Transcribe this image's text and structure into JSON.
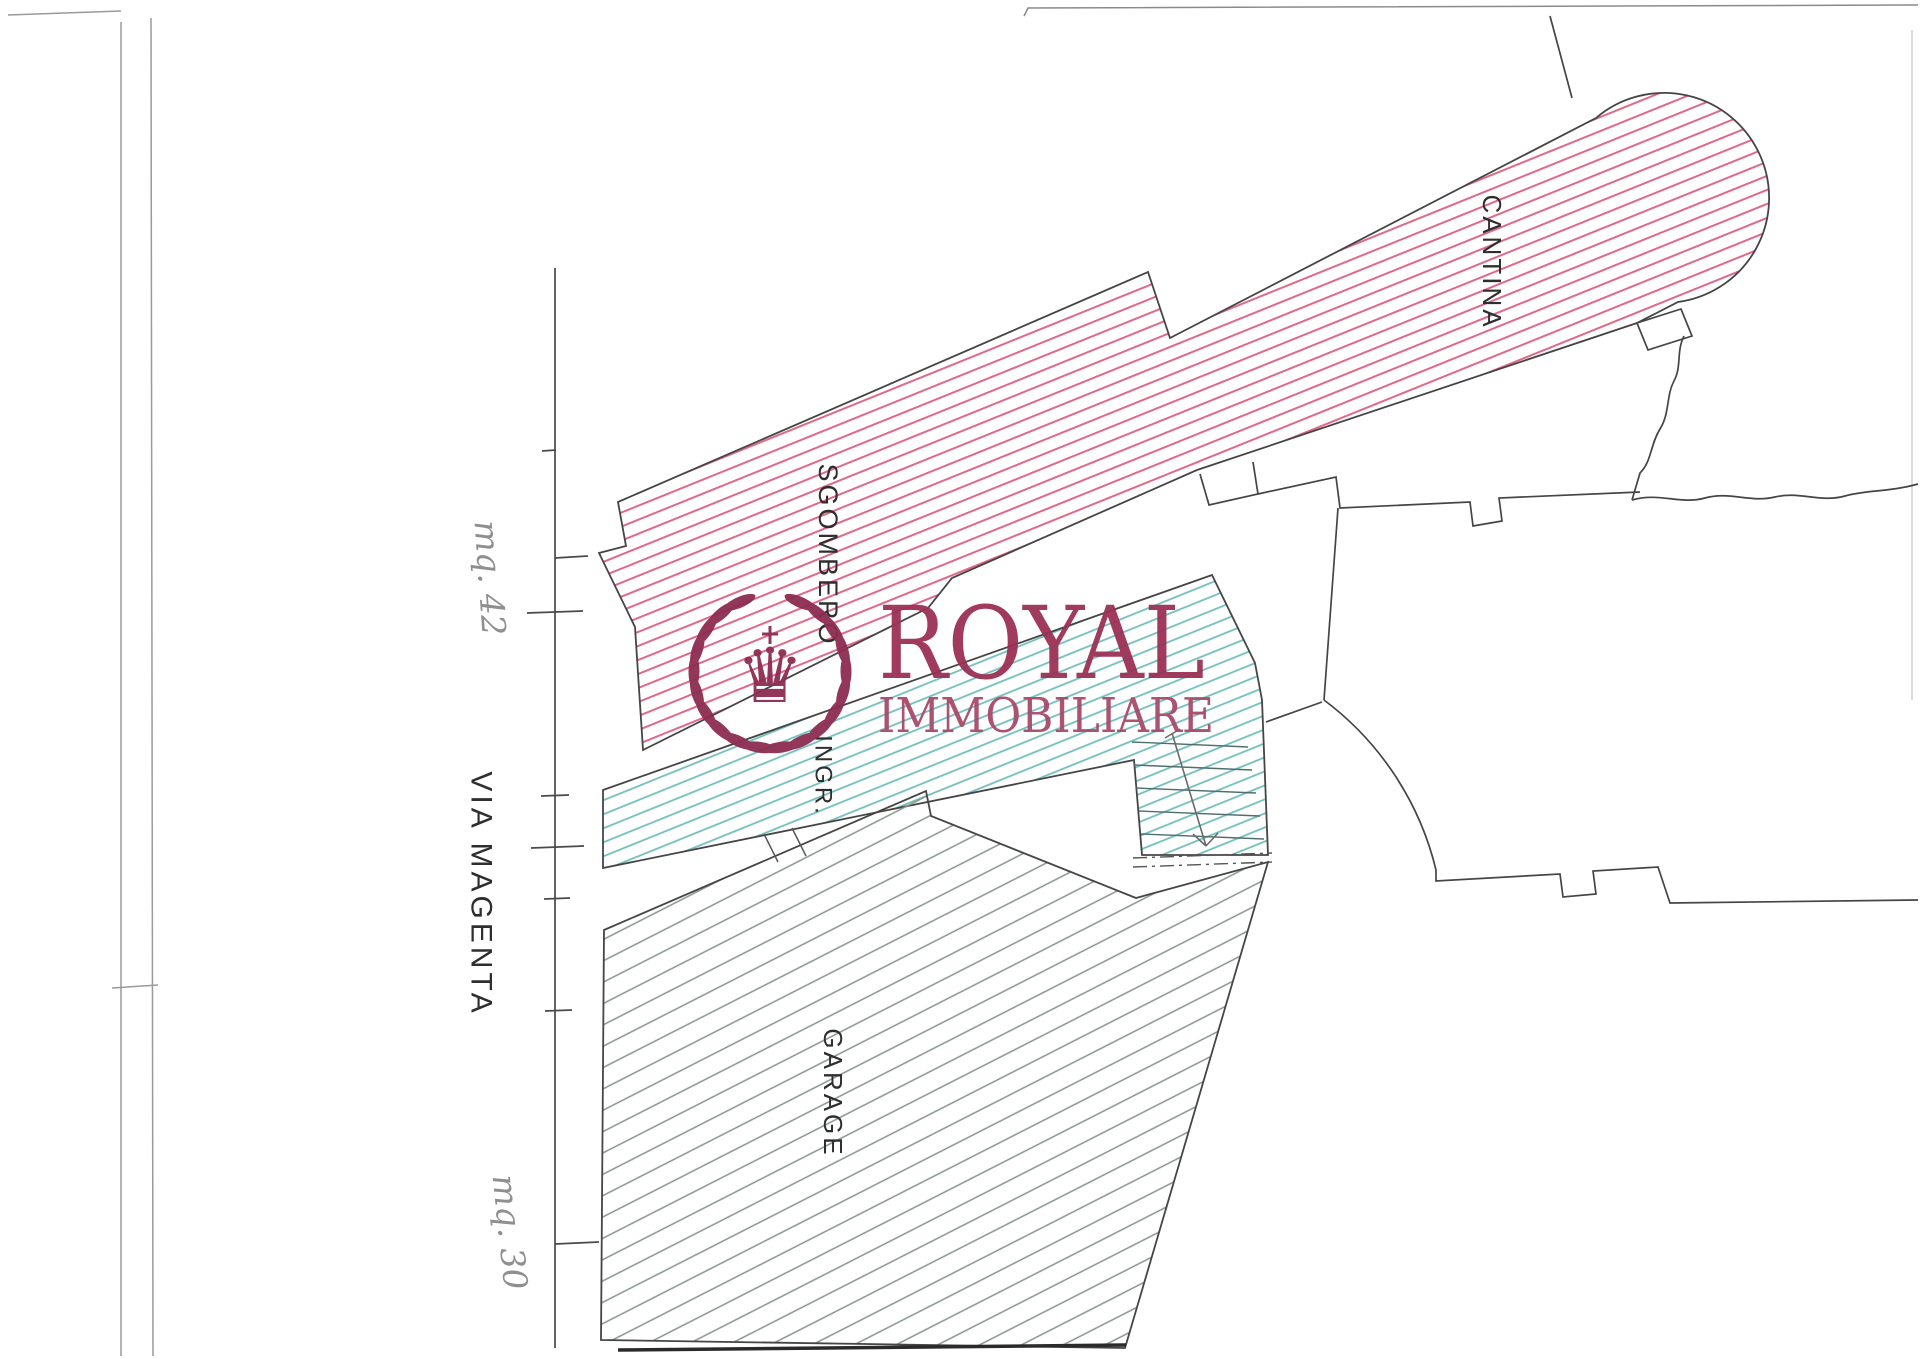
{
  "plan": {
    "rooms": {
      "sgombero": "SGOMBERO",
      "cantina": "CANTINA",
      "ingresso": "INGR.",
      "garage": "GARAGE"
    },
    "street": "VIA MAGENTA",
    "annotations": {
      "sgombero_area": "mq. 42",
      "garage_area": "mq. 30"
    }
  },
  "logo": {
    "name": "ROYAL",
    "subtitle": "IMMOBILIARE",
    "crown_icon": "crown-icon",
    "wreath_icon": "laurel-wreath-icon",
    "crown_glyph": "♛"
  },
  "colors": {
    "pink_hatch": "#e2688a",
    "teal_hatch": "#72bfbc",
    "gray_hatch": "#87948c",
    "outline": "#454545",
    "street_line": "#4a4a4a",
    "logo_maroon": "#9b3156",
    "logo_maroon_dark": "#8e2d52",
    "handwriting": "#8f8f8f",
    "label_text": "#2e2e2e",
    "scan_edge": "#9a9a9a"
  }
}
